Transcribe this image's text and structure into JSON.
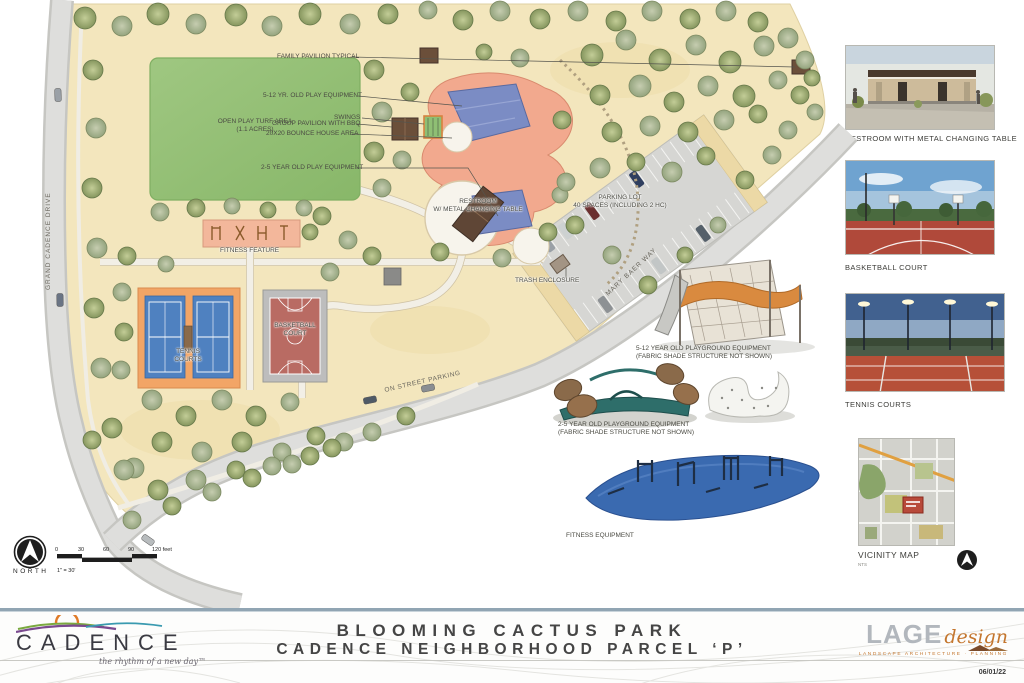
{
  "title_block": {
    "title_line1": "BLOOMING CACTUS PARK",
    "title_line2": "CADENCE NEIGHBORHOOD PARCEL ‘P’",
    "date": "06/01/22"
  },
  "branding": {
    "cadence_wordmark": "CADENCE",
    "cadence_tagline": "the rhythm of a new day™",
    "lage_wordmark": "LAGE",
    "lage_script": "design",
    "lage_tagline": "LANDSCAPE ARCHITECTURE · PLANNING"
  },
  "plan": {
    "streets": {
      "grand_cadence": "GRAND CADENCE DRIVE",
      "mary_baer": "MARY BAER WAY",
      "on_street": "ON STREET PARKING"
    },
    "callouts": {
      "family_pavilion": "FAMILY PAVILION TYPICAL",
      "play_5_12": "5-12 YR. OLD PLAY EQUIPMENT",
      "open_play_1": "OPEN PLAY TURF AREA",
      "open_play_2": "(1.1 ACRES)",
      "swings": "SWINGS",
      "group_pavilion": "GROUP PAVILION WITH BBQ",
      "bounce_house": "20X20 BOUNCE HOUSE AREA",
      "play_2_5": "2-5 YEAR OLD PLAY EQUIPMENT",
      "restroom_1": "RESTROOM",
      "restroom_2": "W/ METAL CHANGING TABLE",
      "parking_1": "PARKING LOT",
      "parking_2": "40 SPACES (INCLUDING 2 HC)",
      "fitness_feature": "FITNESS FEATURE",
      "trash": "TRASH ENCLOSURE",
      "tennis_1": "TENNIS",
      "tennis_2": "COURTS",
      "basketball_1": "BASKETBALL",
      "basketball_2": "COURT"
    }
  },
  "renderings": {
    "play_5_12": {
      "line1": "5-12 YEAR OLD PLAYGROUND EQUIPMENT",
      "line2": "(FABRIC SHADE STRUCTURE NOT SHOWN)"
    },
    "play_2_5": {
      "line1": "2-5 YEAR OLD PLAYGROUND EQUIPMENT",
      "line2": "(FABRIC SHADE STRUCTURE NOT SHOWN)"
    },
    "fitness": {
      "line1": "FITNESS EQUIPMENT"
    }
  },
  "side_panel": {
    "restroom": {
      "label": "RESTROOM WITH METAL CHANGING TABLE"
    },
    "basketball": {
      "label": "BASKETBALL COURT"
    },
    "tennis": {
      "label": "TENNIS COURTS"
    },
    "vicinity": {
      "label": "VICINITY MAP",
      "note": "NTS"
    }
  },
  "legend": {
    "north_label": "NORTH",
    "scale_ticks": [
      "0",
      "30",
      "60",
      "90",
      "120 feet"
    ],
    "scale_note": "1\" = 30'"
  },
  "colors": {
    "ground_tan": "#f3e6bd",
    "turf_green": "#93c07a",
    "tree_olive": "#8a9a62",
    "tennis_orange": "#f2a566",
    "court_blue": "#4f81c0",
    "basketball_red": "#b96b63",
    "playground_salmon": "#f2a98e",
    "fitness_blob_blue": "#3a6ab0",
    "road_gray": "#dcdcdc",
    "footer_band_blue": "#91a5b3",
    "lage_orange": "#c4762e"
  }
}
